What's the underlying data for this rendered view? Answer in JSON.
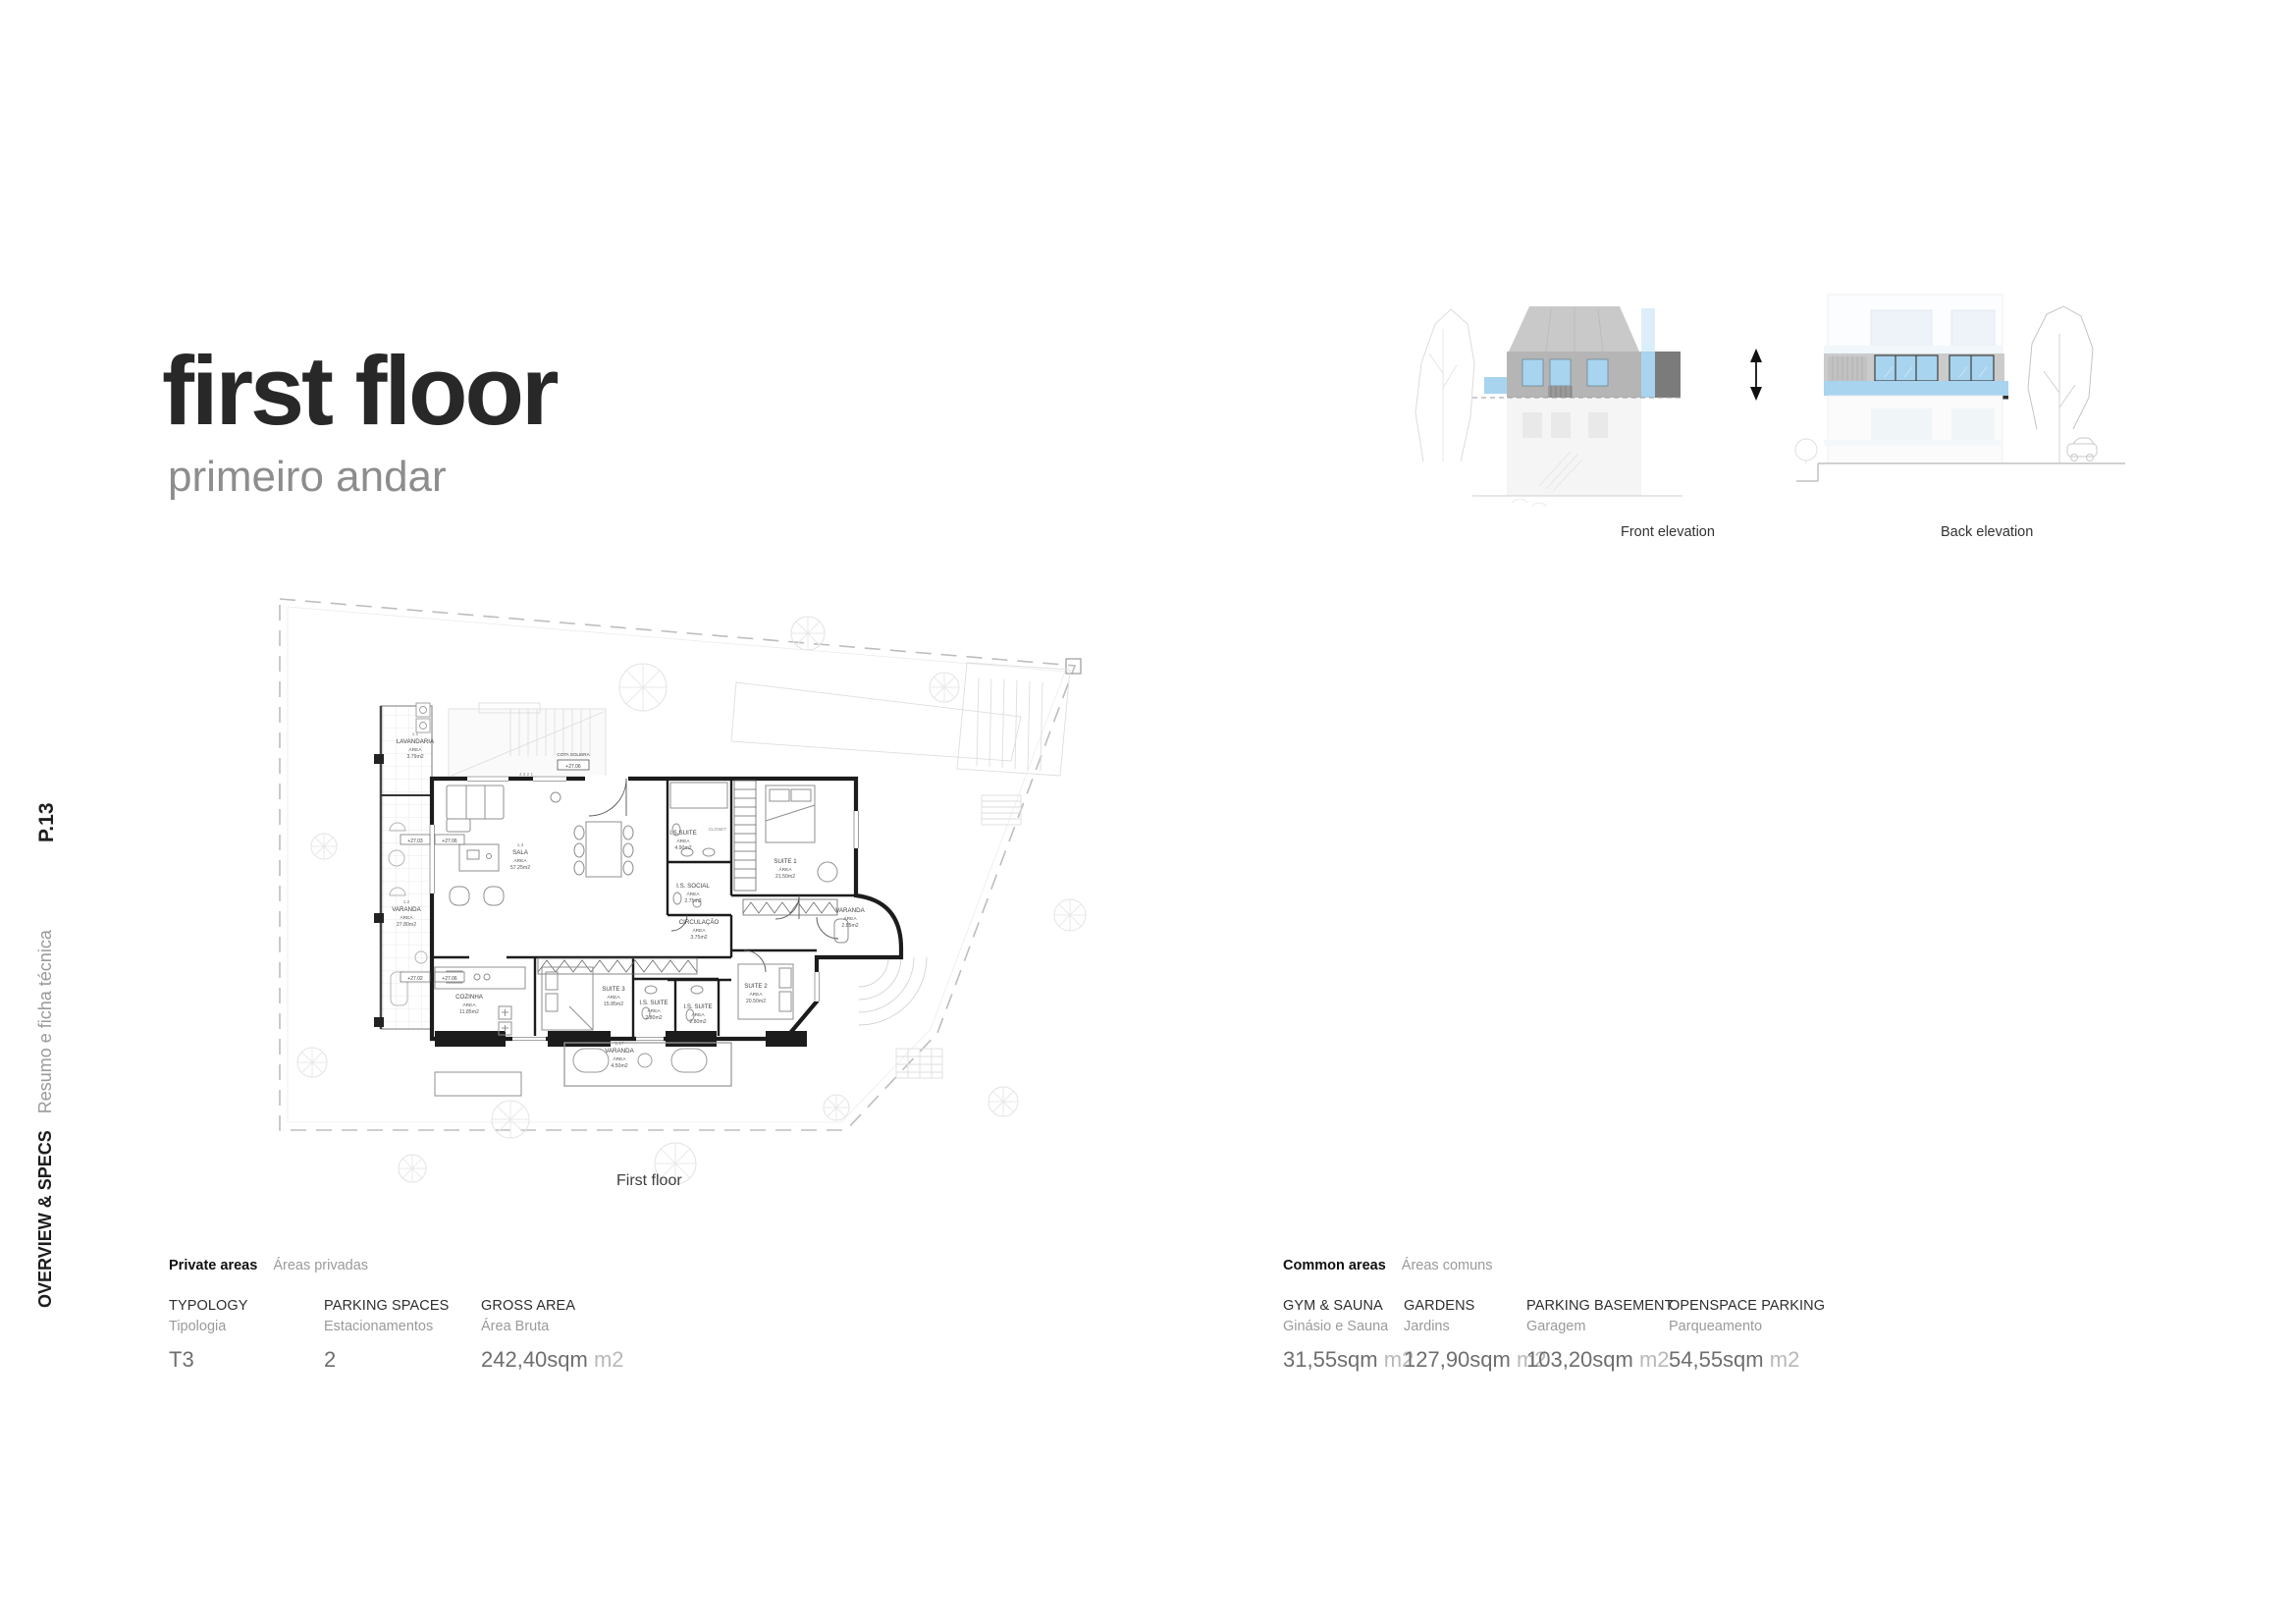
{
  "page": {
    "number": "P.13",
    "section_en": "OVERVIEW & SPECS",
    "section_pt": "Resumo e ficha técnica",
    "title": "first floor",
    "subtitle": "primeiro andar"
  },
  "floor_plan": {
    "caption": "First floor",
    "area_word": "ÁREA",
    "cota_label": "COTA SOLEIRA",
    "cota_value": "+27.06",
    "stair_numbers": "4  3  2  1",
    "level_markers": [
      "+27.03",
      "+27.06",
      "+27.02",
      "+27.06"
    ],
    "rooms": [
      {
        "id": "1.1",
        "name": "LAVANDARIA",
        "area": "3.79m2"
      },
      {
        "id": "1.2",
        "name": "VARANDA",
        "area": "27.80m2"
      },
      {
        "id": "1.3",
        "name": "SALA",
        "area": "57.25m2"
      },
      {
        "name": "I.S.SUITE",
        "area": "4.90m2"
      },
      {
        "name": "CLOSET"
      },
      {
        "name": "SUITE 1",
        "area": "21.50m2"
      },
      {
        "name": "I.S. SOCIAL",
        "area": "2.75m2"
      },
      {
        "name": "CIRCULAÇÃO",
        "area": "3.75m2"
      },
      {
        "name": "VARANDA",
        "area": "2.85m2"
      },
      {
        "name": "COZINHA",
        "area": "11.85m2"
      },
      {
        "name": "SUITE 3",
        "area": "15.85m2"
      },
      {
        "name": "I.S. SUITE",
        "area": "2.80m2"
      },
      {
        "name": "I.S. SUITE",
        "area": "2.80m2"
      },
      {
        "name": "SUITE 2",
        "area": "20.50m2"
      },
      {
        "id": "1.17",
        "name": "VARANDA",
        "area": "4.50m2"
      }
    ]
  },
  "elevations": {
    "front_label": "Front elevation",
    "back_label": "Back elevation"
  },
  "private_areas": {
    "title_en": "Private areas",
    "title_pt": "Áreas privadas",
    "items": [
      {
        "label_en": "TYPOLOGY",
        "label_pt": "Tipologia",
        "value": "T3"
      },
      {
        "label_en": "PARKING SPACES",
        "label_pt": "Estacionamentos",
        "value": "2"
      },
      {
        "label_en": "GROSS AREA",
        "label_pt": "Área Bruta",
        "value": "242,40sqm",
        "unit": "m2"
      }
    ]
  },
  "common_areas": {
    "title_en": "Common areas",
    "title_pt": "Áreas comuns",
    "items": [
      {
        "label_en": "GYM & SAUNA",
        "label_pt": "Ginásio e Sauna",
        "value": "31,55sqm",
        "unit": "m2"
      },
      {
        "label_en": "GARDENS",
        "label_pt": "Jardins",
        "value": "127,90sqm",
        "unit": "m2"
      },
      {
        "label_en": "PARKING BASEMENT",
        "label_pt": "Garagem",
        "value": "103,20sqm",
        "unit": "m2"
      },
      {
        "label_en": "OPENSPACE PARKING",
        "label_pt": "Parqueamento",
        "value": "54,55sqm",
        "unit": "m2"
      }
    ]
  },
  "colors": {
    "accent_blue": "#a8d4ef",
    "wall_gray": "#b5b5b5",
    "band_gray": "#cbcbcb",
    "roof_gray": "#c9c9c9",
    "dark_gray": "#7b7b7b"
  }
}
